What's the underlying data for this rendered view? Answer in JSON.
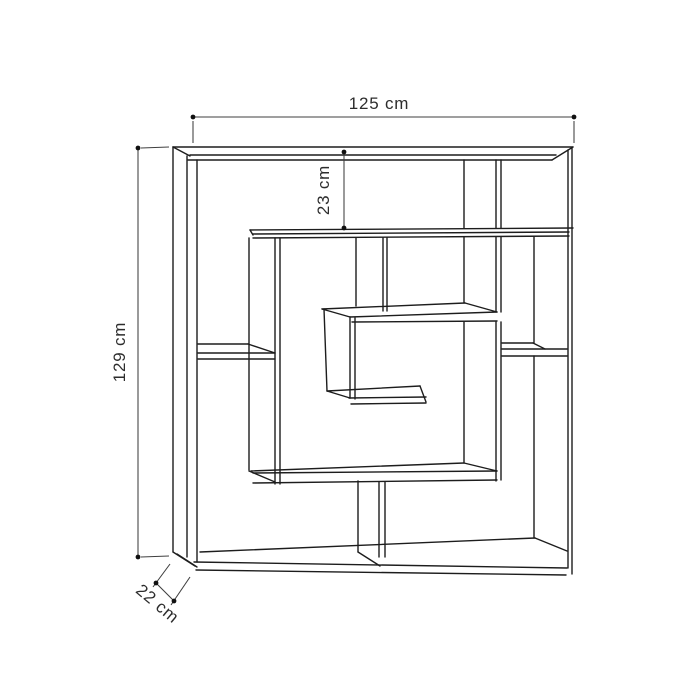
{
  "canvas": {
    "width": 700,
    "height": 700,
    "background": "#ffffff",
    "structure_color": "#1d1d1d",
    "structure_stroke_width": 1.4,
    "dim_color": "#3f3f3f",
    "dim_stroke_width": 1.05,
    "dot_color": "#111111",
    "dot_radius": 2.4,
    "text_color": "#2d2d2d",
    "font_size": 17
  },
  "drawing": {
    "description": "maze-style-bookshelf-technical-drawing",
    "structure_lines": [
      [
        173,
        147,
        573,
        147
      ],
      [
        190,
        155,
        556,
        155
      ],
      [
        188,
        160,
        552,
        160
      ],
      [
        573,
        147,
        552,
        160
      ],
      [
        173,
        147,
        190,
        156
      ],
      [
        173,
        147,
        173,
        552
      ],
      [
        187,
        156,
        187,
        557
      ],
      [
        197,
        160,
        197,
        562
      ],
      [
        173,
        552,
        195,
        566
      ],
      [
        177,
        554,
        197,
        567
      ],
      [
        200,
        552,
        535,
        538
      ],
      [
        194,
        562,
        567,
        568
      ],
      [
        196,
        570,
        566,
        575
      ],
      [
        535,
        538,
        567,
        551
      ],
      [
        568,
        150,
        568,
        568
      ],
      [
        572,
        148,
        572,
        574
      ],
      [
        534,
        237,
        534,
        343
      ],
      [
        534,
        356,
        534,
        538
      ],
      [
        464,
        160,
        464,
        228
      ],
      [
        464,
        237,
        464,
        303
      ],
      [
        464,
        322,
        464,
        463
      ],
      [
        496,
        160,
        496,
        228
      ],
      [
        496,
        237,
        496,
        312
      ],
      [
        496,
        322,
        496,
        481
      ],
      [
        501,
        160,
        501,
        228
      ],
      [
        501,
        237,
        501,
        312
      ],
      [
        501,
        322,
        501,
        480
      ],
      [
        250,
        230,
        573,
        228
      ],
      [
        253,
        234,
        569,
        232
      ],
      [
        253,
        238,
        569,
        236
      ],
      [
        250,
        230,
        253,
        235
      ],
      [
        249,
        238,
        249,
        470
      ],
      [
        275,
        238,
        275,
        484
      ],
      [
        280,
        238,
        280,
        484
      ],
      [
        249,
        471,
        275,
        482
      ],
      [
        356,
        238,
        356,
        306
      ],
      [
        383,
        238,
        383,
        311
      ],
      [
        387,
        238,
        387,
        311
      ],
      [
        198,
        344,
        248,
        344
      ],
      [
        248,
        344,
        275,
        353
      ],
      [
        198,
        353,
        275,
        353
      ],
      [
        198,
        359,
        275,
        359
      ],
      [
        502,
        343,
        533,
        343
      ],
      [
        533,
        343,
        545,
        349
      ],
      [
        502,
        349,
        567,
        349
      ],
      [
        502,
        356,
        567,
        356
      ],
      [
        322,
        309,
        465,
        303
      ],
      [
        322,
        309,
        350,
        317
      ],
      [
        465,
        303,
        497,
        312
      ],
      [
        350,
        317,
        497,
        312
      ],
      [
        352,
        322,
        497,
        321
      ],
      [
        324,
        309,
        327,
        391
      ],
      [
        350,
        317,
        350,
        398
      ],
      [
        355,
        318,
        355,
        399
      ],
      [
        327,
        391,
        420,
        386
      ],
      [
        327,
        391,
        350,
        398
      ],
      [
        349,
        398,
        426,
        397
      ],
      [
        351,
        404,
        426,
        403
      ],
      [
        420,
        386,
        426,
        402
      ],
      [
        251,
        471,
        464,
        463
      ],
      [
        253,
        473,
        497,
        471
      ],
      [
        253,
        483,
        497,
        480
      ],
      [
        464,
        463,
        497,
        471
      ],
      [
        358,
        481,
        358,
        552
      ],
      [
        379,
        482,
        379,
        557
      ],
      [
        385,
        482,
        385,
        557
      ],
      [
        358,
        552,
        380,
        566
      ]
    ]
  },
  "dimensions": [
    {
      "name": "dim-width",
      "text": "125 cm",
      "line": [
        193,
        117,
        574,
        117
      ],
      "dots": [
        [
          193,
          117
        ],
        [
          574,
          117
        ]
      ],
      "extensions": [
        [
          193,
          121,
          193,
          143
        ],
        [
          574,
          121,
          574,
          143
        ]
      ],
      "label": {
        "x": 379,
        "y": 109,
        "rotate": 0
      }
    },
    {
      "name": "dim-top-gap",
      "text": "23 cm",
      "line": [
        344,
        152,
        344,
        228
      ],
      "dots": [
        [
          344,
          152
        ],
        [
          344,
          228
        ]
      ],
      "extensions": [],
      "label": {
        "x": 329,
        "y": 190,
        "rotate": -90
      }
    },
    {
      "name": "dim-height",
      "text": "129 cm",
      "line": [
        138,
        148,
        138,
        557
      ],
      "dots": [
        [
          138,
          148
        ],
        [
          138,
          557
        ]
      ],
      "extensions": [
        [
          141,
          148,
          169,
          147
        ],
        [
          141,
          557,
          169,
          556
        ]
      ],
      "label": {
        "x": 125,
        "y": 352,
        "rotate": -90
      }
    },
    {
      "name": "dim-depth",
      "text": "22 cm",
      "line": [
        156,
        583,
        174,
        601
      ],
      "dots": [
        [
          156,
          583
        ],
        [
          174,
          601
        ]
      ],
      "extensions": [
        [
          153,
          587,
          170,
          564
        ],
        [
          171,
          605,
          190,
          577
        ]
      ],
      "label": {
        "x": 154,
        "y": 608,
        "rotate": 40
      }
    }
  ]
}
